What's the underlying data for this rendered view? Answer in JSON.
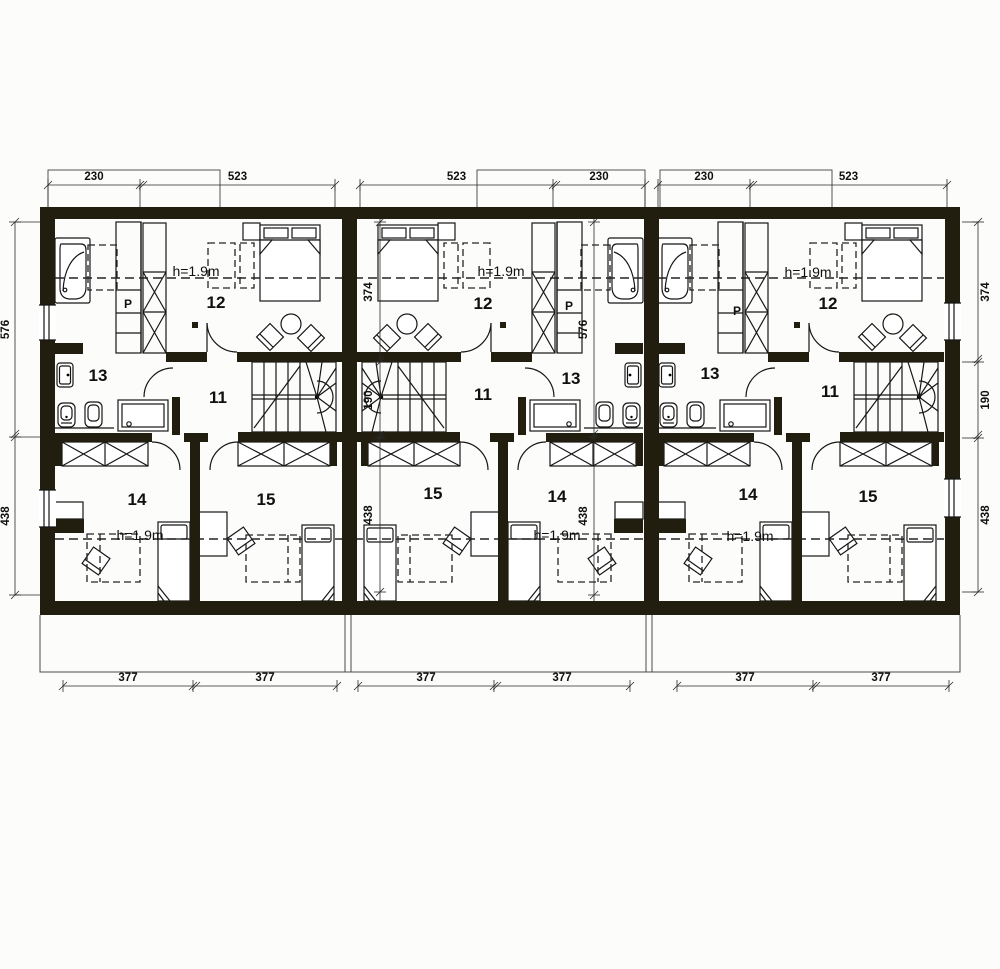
{
  "plan": {
    "rooms": {
      "hall": "11",
      "upper_bedroom": "12",
      "bathroom": "13",
      "lower_bedroom_left": "14",
      "lower_bedroom_right": "15"
    },
    "notes": {
      "closet": "P",
      "ceiling_height": "h=1.9m"
    },
    "dims": {
      "top": [
        "230",
        "523",
        "523",
        "230",
        "230",
        "523"
      ],
      "bottom": [
        "377",
        "377",
        "377",
        "377",
        "377",
        "377"
      ],
      "left": [
        "576",
        "438"
      ],
      "right": [
        "374",
        "190",
        "438"
      ],
      "middle_stair_side": [
        "374",
        "190",
        "438"
      ],
      "middle_bath_side": [
        "576",
        "438"
      ]
    },
    "units": [
      {
        "id": "left",
        "mirrored": false
      },
      {
        "id": "middle",
        "mirrored": true
      },
      {
        "id": "right",
        "mirrored": false
      }
    ],
    "colors": {
      "wall": "#211e10",
      "line": "#161616",
      "bg": "#fcfdfa"
    }
  }
}
